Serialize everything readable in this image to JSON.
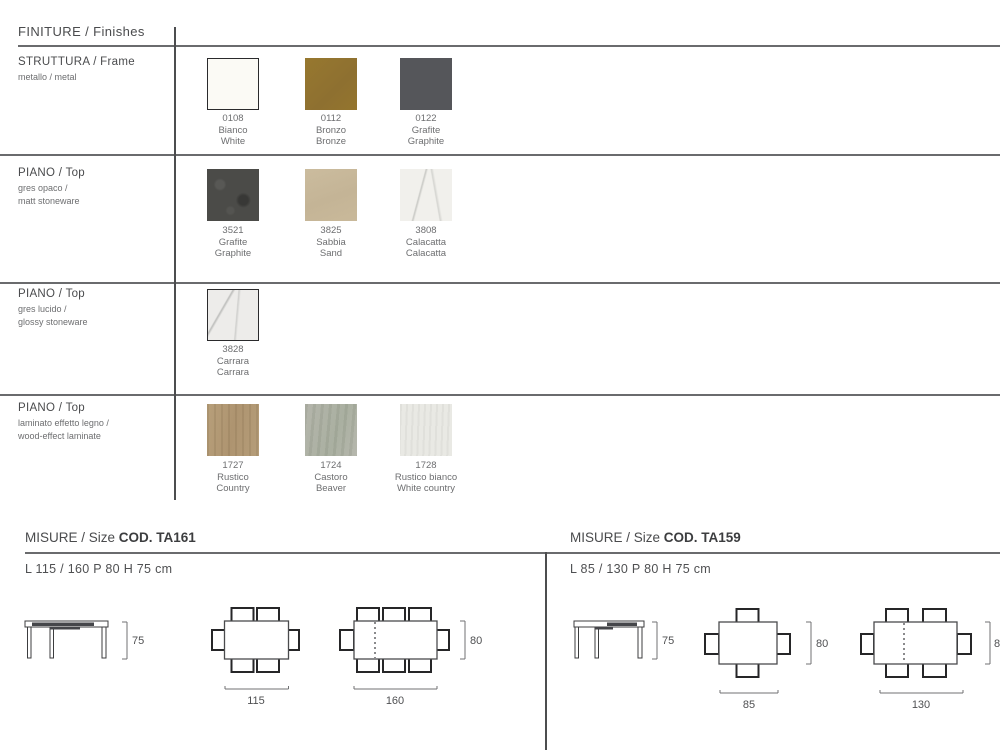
{
  "finiture": {
    "title": "FINITURE / Finishes",
    "rows": [
      {
        "title": "STRUTTURA / Frame",
        "subtitle1": "metallo / metal",
        "subtitle2": "",
        "swatches": [
          {
            "code": "0108",
            "name": "Bianco",
            "name_en": "White",
            "color": "#fbfaf5"
          },
          {
            "code": "0112",
            "name": "Bronzo",
            "name_en": "Bronze",
            "color": "#8f7230"
          },
          {
            "code": "0122",
            "name": "Grafite",
            "name_en": "Graphite",
            "color": "#55565a"
          }
        ]
      },
      {
        "title": "PIANO / Top",
        "subtitle1": "gres opaco /",
        "subtitle2": "matt stoneware",
        "swatches": [
          {
            "code": "3521",
            "name": "Grafite",
            "name_en": "Graphite",
            "color": "#4b4b48"
          },
          {
            "code": "3825",
            "name": "Sabbia",
            "name_en": "Sand",
            "color": "#c7b899"
          },
          {
            "code": "3808",
            "name": "Calacatta",
            "name_en": "Calacatta",
            "color": "#f1f0ec"
          }
        ]
      },
      {
        "title": "PIANO / Top",
        "subtitle1": "gres lucido /",
        "subtitle2": "glossy stoneware",
        "swatches": [
          {
            "code": "3828",
            "name": "Carrara",
            "name_en": "Carrara",
            "color": "#edecea"
          }
        ]
      },
      {
        "title": "PIANO / Top",
        "subtitle1": "laminato effetto legno /",
        "subtitle2": "wood-effect laminate",
        "swatches": [
          {
            "code": "1727",
            "name": "Rustico",
            "name_en": "Country",
            "color": "#b29a75"
          },
          {
            "code": "1724",
            "name": "Castoro",
            "name_en": "Beaver",
            "color": "#b1b2a8"
          },
          {
            "code": "1728",
            "name": "Rustico bianco",
            "name_en": "White country",
            "color": "#e9e9e4"
          }
        ]
      }
    ]
  },
  "misure": [
    {
      "label": "MISURE / Size",
      "code": "COD. TA161",
      "dimensions": "L 115 / 160 P 80 H 75 cm",
      "height": "75",
      "depth": "80",
      "length_small": "115",
      "length_large": "160"
    },
    {
      "label": "MISURE / Size",
      "code": "COD. TA159",
      "dimensions": "L 85 / 130 P 80 H 75 cm",
      "height": "75",
      "depth": "80",
      "length_small": "85",
      "length_large": "130"
    }
  ]
}
